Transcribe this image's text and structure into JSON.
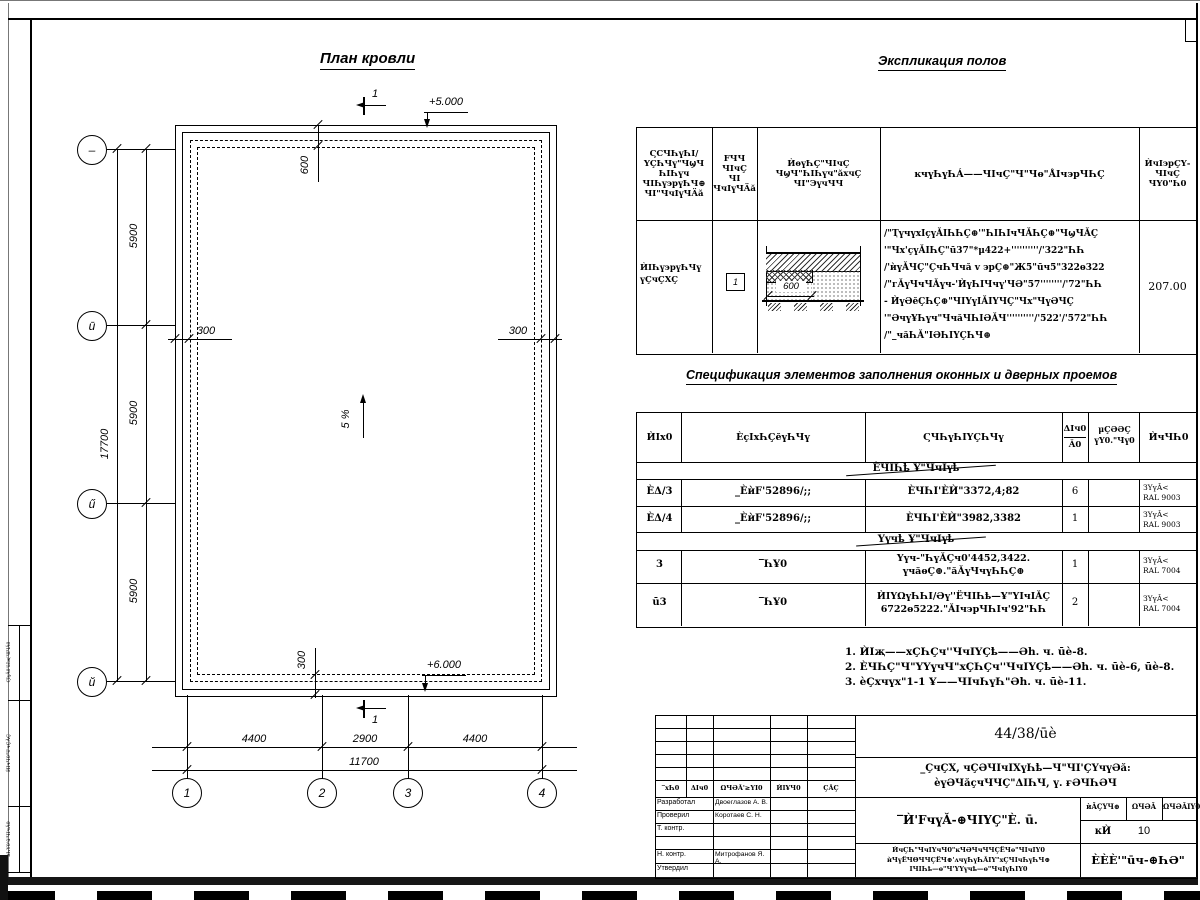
{
  "titles": {
    "plan": "План кровли",
    "expl": "Экспликация полов",
    "spec": "Спецификация элементов заполнения оконных и дверных проемов"
  },
  "plan": {
    "elev_top": "+5.000",
    "elev_bottom": "+6.000",
    "slope": "5 %",
    "section": "1",
    "dim600": "600",
    "dim300": "300",
    "row_dims": [
      "5900",
      "5900",
      "5900"
    ],
    "row_total": "17700",
    "col_dims": [
      "4400",
      "2900",
      "4400"
    ],
    "col_total": "11700",
    "row_grid": [
      "–",
      "ū",
      "ű",
      "ŭ"
    ],
    "col_grid": [
      "1",
      "2",
      "3",
      "4"
    ]
  },
  "expl": {
    "h1": "ϚϹЧҺүҺI/\nҮÇҺЧү\"ЧϣЧ\nҺIҺүч\nЧIҺү϶рүҺЧ⊕\nЧI\"ЧчIүЧÄă",
    "h2": "FЧЧ\nЧIчÇ\nЧI\nЧчIүЧÄă",
    "h3": "ЍѳүҺÇ\"ЧIчÇ\nЧϣЧ\"ҺIҺүч\"ăхчÇ\nЧI\"ЭүчЧЧ",
    "h4": "ĸчүҺүҺÁ——ЧIчÇ\"Ч\"Чѳ\"ÅIч϶рЧҺÇ",
    "h5": "ЍчI϶рÇҮ-\nЧIчÇ\nЧҮ0\"Һ0",
    "row_name": "ЍIҺү϶рүҺЧү\nүÇчÇХÇ",
    "row_num": "1",
    "detail_dim": "600",
    "desc": "/\"ҬүчүхIçүǍIҺҺÇ⊕'\"ҺIҺIчЧǍҺÇ⊕\"ЧϣЧǍÇ\n'\"Чх'çүǍIҺÇ\"ū37\"*μ422+''''''''''/'322\"ҺҺ\n/'ѝүǍЧÇ\"ÇчҺЧчă v ϶рÇ⊕\"Ж5\"ūч5\"322ѳ322\n/\"гǍүЧчЧǍүч-'ЍүҺIЧчү'ЧƏ\"57''''''''/'72\"ҺҺ\n- ЍүƏĕÇҺÇ⊕\"ЧIҮүIǍIҮЧÇ\"Чх\"ЧүƏЧÇ\n'\"ƏчүҰҺүч\"ЧчăЧҺIƏǍЧ''''''''''/'522'/'572\"ҺҺ\n/\"_чăҺǍ\"IƏҺIҮÇҺЧ⊕",
    "area": "207.00"
  },
  "spec": {
    "h_pos": "ЍIx0",
    "h_obozn": "ÈçIxҺÇĕүҺЧү",
    "h_naimen": "ϚЧҺүҺIҮÇҺЧү",
    "h_kol_top": "ΔIч0",
    "h_kol_bot": "Ǎ0",
    "h_massa": "μÇƏƏÇ\nүҮ0.\"Чү0",
    "h_prim": "ЍчЧҺ0",
    "section1": "ÈЧIҺҍ   Ұ\"ЧчIүҍ",
    "section2": "Үүчҍ   Ұ\"ЧчIүҍ",
    "rows": [
      {
        "pos": "ÈΔ/3",
        "obozn": "_ÈѝF'52896/;;",
        "naimen": "ÈЧҺI'ÈЍ\"3372,4;82",
        "kol": "6",
        "prim": "ЗҮүǍ<\nRAL 9003"
      },
      {
        "pos": "ÈΔ/4",
        "obozn": "_ÈѝF'52896/;;",
        "naimen": "ÈЧҺI'ÈЍ\"3982,3382",
        "kol": "1",
        "prim": "ЗҮүǍ<\nRAL 9003"
      },
      {
        "pos": "3",
        "obozn": "‾ҺҰ0",
        "naimen": "Үүч-\"ҺүǍÇч0'4452,3422.\nүчăѳÇ⊕.\"ăǍүЧчүҺҺÇ⊕",
        "kol": "1",
        "prim": "ЗҮүǍ<\nRAL 7004"
      },
      {
        "pos": "ū3",
        "obozn": "‾ҺҰ0",
        "naimen": "ЍIҮΩүҺҺI/Əү''ЁЧIҺҍ—Ұ\"ҮIчIǍÇ\n6722ѳ5222.\"ǍIч϶рЧҺIч'92\"ҺҺ",
        "kol": "2",
        "prim": "ЗҮүǍ<\nRAL 7004"
      }
    ]
  },
  "notes": [
    "1. ЍIҗ——хÇҺÇч''ЧчIҮÇҍ——Əh. ч. ūè-8.",
    "2. ÈЧҺÇ\"Ч\"ҮҮүчЧ\"хÇҺÇч''ЧчIҮÇҍ——Əh. ч. ūè-6, ūè-8.",
    "3. èÇхчүх\"1-1 Ұ——ЧIчҺүҺ\"Əh. ч. ūè-11."
  ],
  "stamp": {
    "doc": "44/38/ūè",
    "project": "_ÇчÇХ, чÇƏЧIчIХүҺҍ—Ч\"ЧI'ÇҮчүƏă:\nèүƏЧăçчЧЧÇ\"ΔIҺЧ, ү. ғƏЧҺƏЧ",
    "sheet_title": "‾Ѝ'FчүǍ-⊕ЧIҮÇ\"È. ū.",
    "cols": [
      "‾хҺ0",
      "ΔIч0",
      "ΩЧƏǍ'≥ҮI0",
      "ЍIҰЧ0",
      "ÇǍÇ"
    ],
    "roles": [
      {
        "r": "Разработал",
        "n": "Двоеглазов А. В."
      },
      {
        "r": "Проверил",
        "n": "Коротаев С. Н."
      },
      {
        "r": "Т. контр.",
        "n": ""
      },
      {
        "r": "",
        "n": ""
      },
      {
        "r": "Н. контр.",
        "n": "Митрофанов Я. А."
      },
      {
        "r": "Утвердил",
        "n": ""
      }
    ],
    "stage_h": [
      "ѝǍÇҮЧ⊕",
      "ΩЧƏǍ",
      "ΩЧƏǍIҮ0"
    ],
    "stage_v": [
      "ĸЍ",
      "10",
      ""
    ],
    "org": "ÈÈÈ'\"ūч-⊕ҺƏ\"",
    "block": "ЍчÇҺ\"ЧчIҮчЧ0\"ĸЧƏЧчЧЧÇЁЧѳ\"ЧIчIҮ0\nѝЧүЁЧΘЧЧÇЁЧ⊕'ʌчүҺүҺǍIҮ\"хÇЧIчҺүҺЧ⊕\nIЧIҺҍ—ѳ\"Ч'ҮҮүчҍ—ѳ\"ЧчIүҺIҮ0"
  },
  "left_strip": [
    "ϚIүǍ0'ūčҗ'ЧIЧǍ0",
    "ЍIчЧ0'Ч'чÇǍÇ",
    "ѝҺҮ0'ū'ЧIчǍ0"
  ]
}
